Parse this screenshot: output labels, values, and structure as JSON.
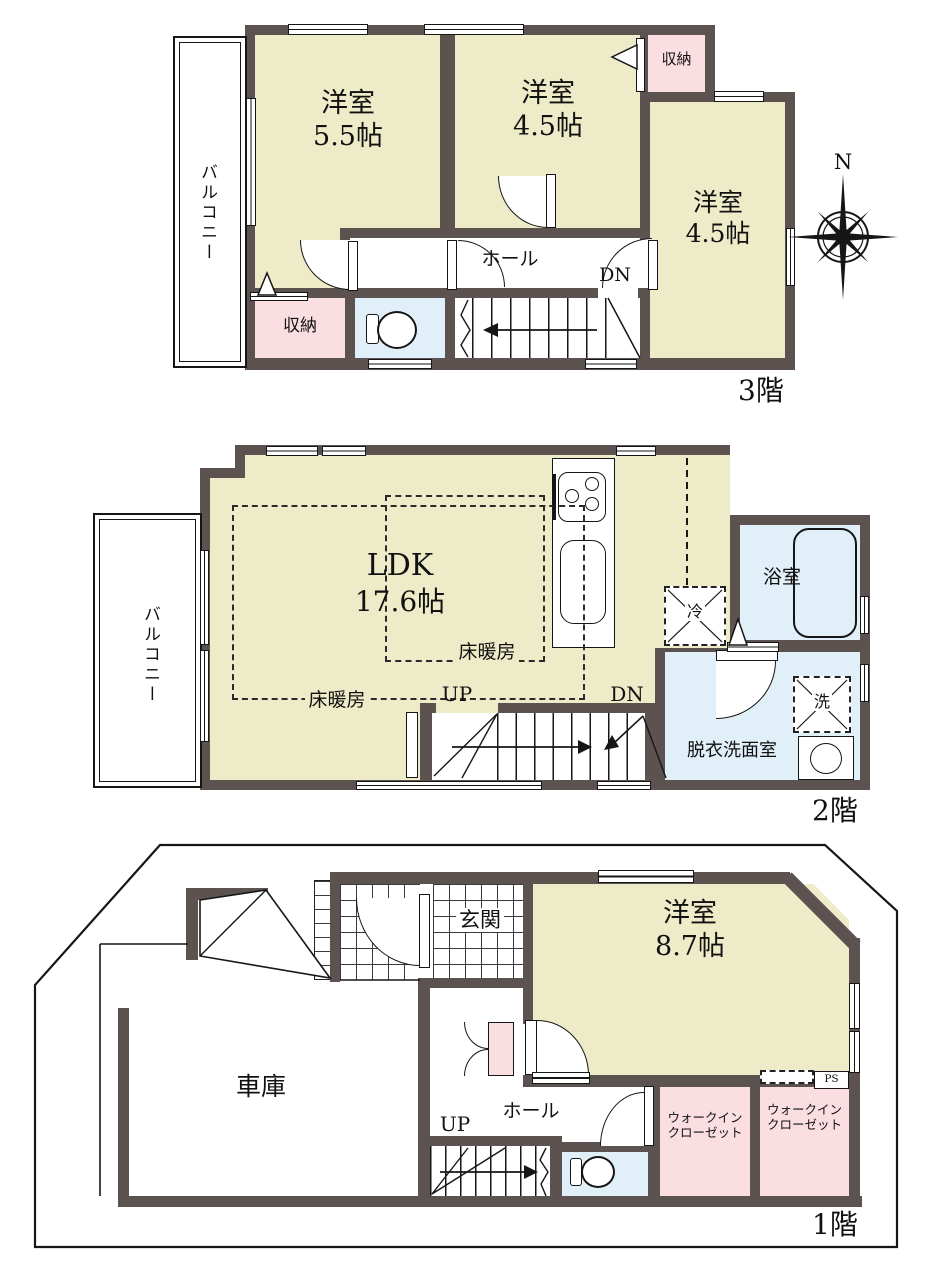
{
  "colors": {
    "wall": "#5c5350",
    "room_beige": "#eeebc8",
    "closet_pink": "#fbdee2",
    "wet_blue": "#e1eff8",
    "line": "#161616"
  },
  "compass": {
    "label": "N"
  },
  "floor3": {
    "floor_label": "3階",
    "balcony": "バルコニー",
    "room_a_name": "洋室",
    "room_a_size": "5.5帖",
    "room_b_name": "洋室",
    "room_b_size": "4.5帖",
    "room_c_name": "洋室",
    "room_c_size": "4.5帖",
    "closet_top": "収納",
    "closet_bottom": "収納",
    "hall": "ホール",
    "dn": "DN"
  },
  "floor2": {
    "floor_label": "2階",
    "balcony": "バルコニー",
    "ldk_name": "LDK",
    "ldk_size": "17.6帖",
    "floor_heating_1": "床暖房",
    "floor_heating_2": "床暖房",
    "fridge": "冷",
    "bath": "浴室",
    "washer": "洗",
    "washroom": "脱衣洗面室",
    "up": "UP",
    "dn": "DN"
  },
  "floor1": {
    "floor_label": "1階",
    "entrance": "玄関",
    "garage": "車庫",
    "room_name": "洋室",
    "room_size": "8.7帖",
    "hall": "ホール",
    "up": "UP",
    "wic_left_1": "ウォークイン",
    "wic_left_2": "クローゼット",
    "wic_right_1": "ウォークイン",
    "wic_right_2": "クローゼット",
    "ps": "PS"
  }
}
